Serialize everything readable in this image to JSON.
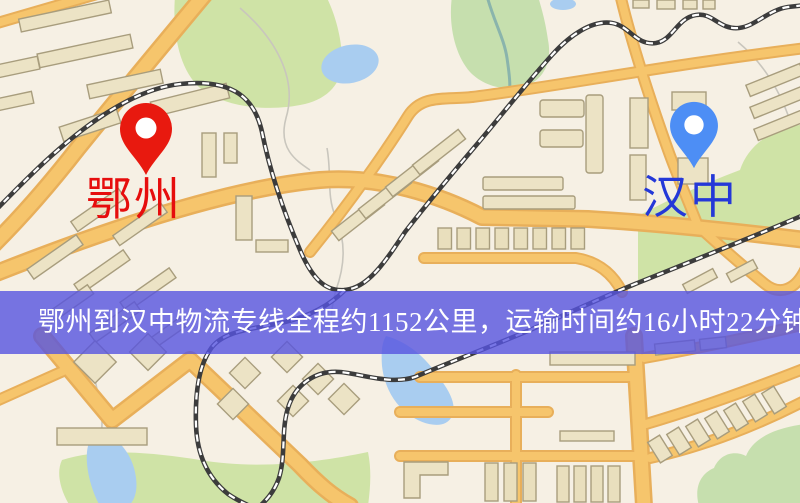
{
  "banner": {
    "text": "鄂州到汉中物流专线全程约1152公里，运输时间约16小时22分钟.",
    "bg_color": "#5654e0",
    "text_color": "#ffffff"
  },
  "markers": [
    {
      "city": "鄂州",
      "pin_color": "#e8190f",
      "label_color": "#e60d0d",
      "pin_style": "map-pin-with-hole"
    },
    {
      "city": "汉中",
      "pin_color": "#4d8ef5",
      "label_color": "#2438d8",
      "pin_style": "map-pin-with-hole"
    }
  ],
  "route": {
    "from": "鄂州",
    "to": "汉中",
    "distance_text": "约1152公里",
    "duration_text": "约16小时22分钟"
  },
  "palette": {
    "background": "#f6f0e4",
    "road_fill": "#f6c56c",
    "road_casing": "#e8af5a",
    "building_fill": "#ece3c5",
    "building_outline": "#a89d7d",
    "park_green": "#cfe3a6",
    "water_blue": "#a9cdf0",
    "railway_dark": "#3c3c3c",
    "railway_light": "#ffffff"
  }
}
